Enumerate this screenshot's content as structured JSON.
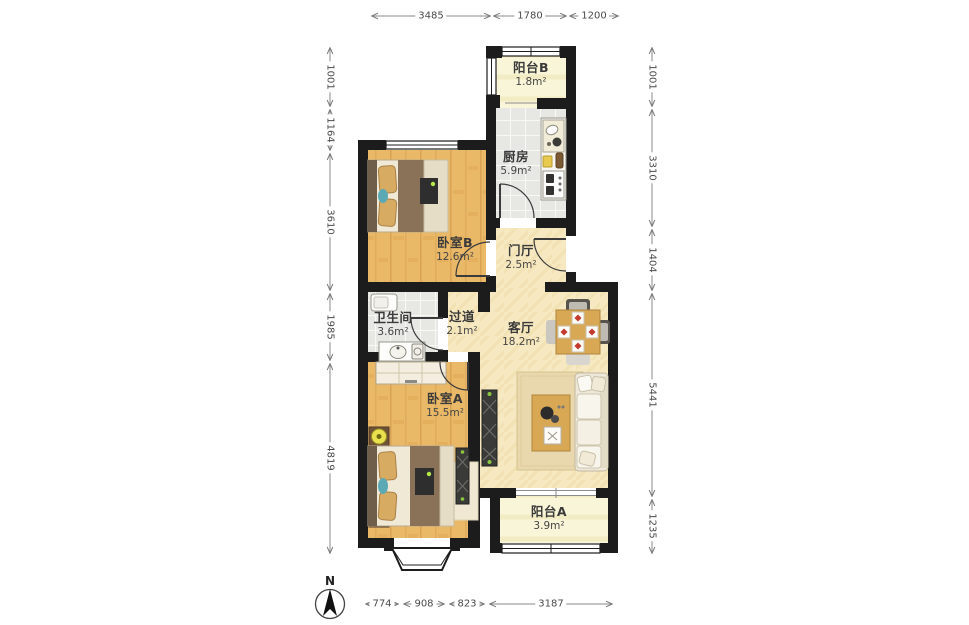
{
  "plan": {
    "rooms": [
      {
        "id": "balcony-b",
        "name": "阳台B",
        "area": "1.8m²"
      },
      {
        "id": "kitchen",
        "name": "厨房",
        "area": "5.9m²"
      },
      {
        "id": "bedroom-b",
        "name": "卧室B",
        "area": "12.6m²"
      },
      {
        "id": "foyer",
        "name": "门厅",
        "area": "2.5m²"
      },
      {
        "id": "bathroom",
        "name": "卫生间",
        "area": "3.6m²"
      },
      {
        "id": "hallway",
        "name": "过道",
        "area": "2.1m²"
      },
      {
        "id": "living-room",
        "name": "客厅",
        "area": "18.2m²"
      },
      {
        "id": "bedroom-a",
        "name": "卧室A",
        "area": "15.5m²"
      },
      {
        "id": "balcony-a",
        "name": "阳台A",
        "area": "3.9m²"
      }
    ],
    "dimensions": {
      "top": [
        "3485",
        "1780",
        "1200"
      ],
      "left": [
        "1001",
        "1164",
        "3610",
        "1985",
        "4819"
      ],
      "right": [
        "1001",
        "3310",
        "1404",
        "5441",
        "1235"
      ],
      "bottom": [
        "774",
        "908",
        "823",
        "3187"
      ]
    },
    "compass": {
      "label": "N"
    },
    "colors": {
      "wall": "#1c1c1c",
      "wood_floor": "#eab968",
      "warm_floor": "#f6e8c0",
      "tile_floor": "#e7e7e4",
      "balcony_floor": "#f9f5d8",
      "table_wood": "#d9a855",
      "accent_teal": "#5aa9b5",
      "lamp_yellow": "#e9e14e",
      "dimension_text": "#4a4a4a"
    }
  }
}
